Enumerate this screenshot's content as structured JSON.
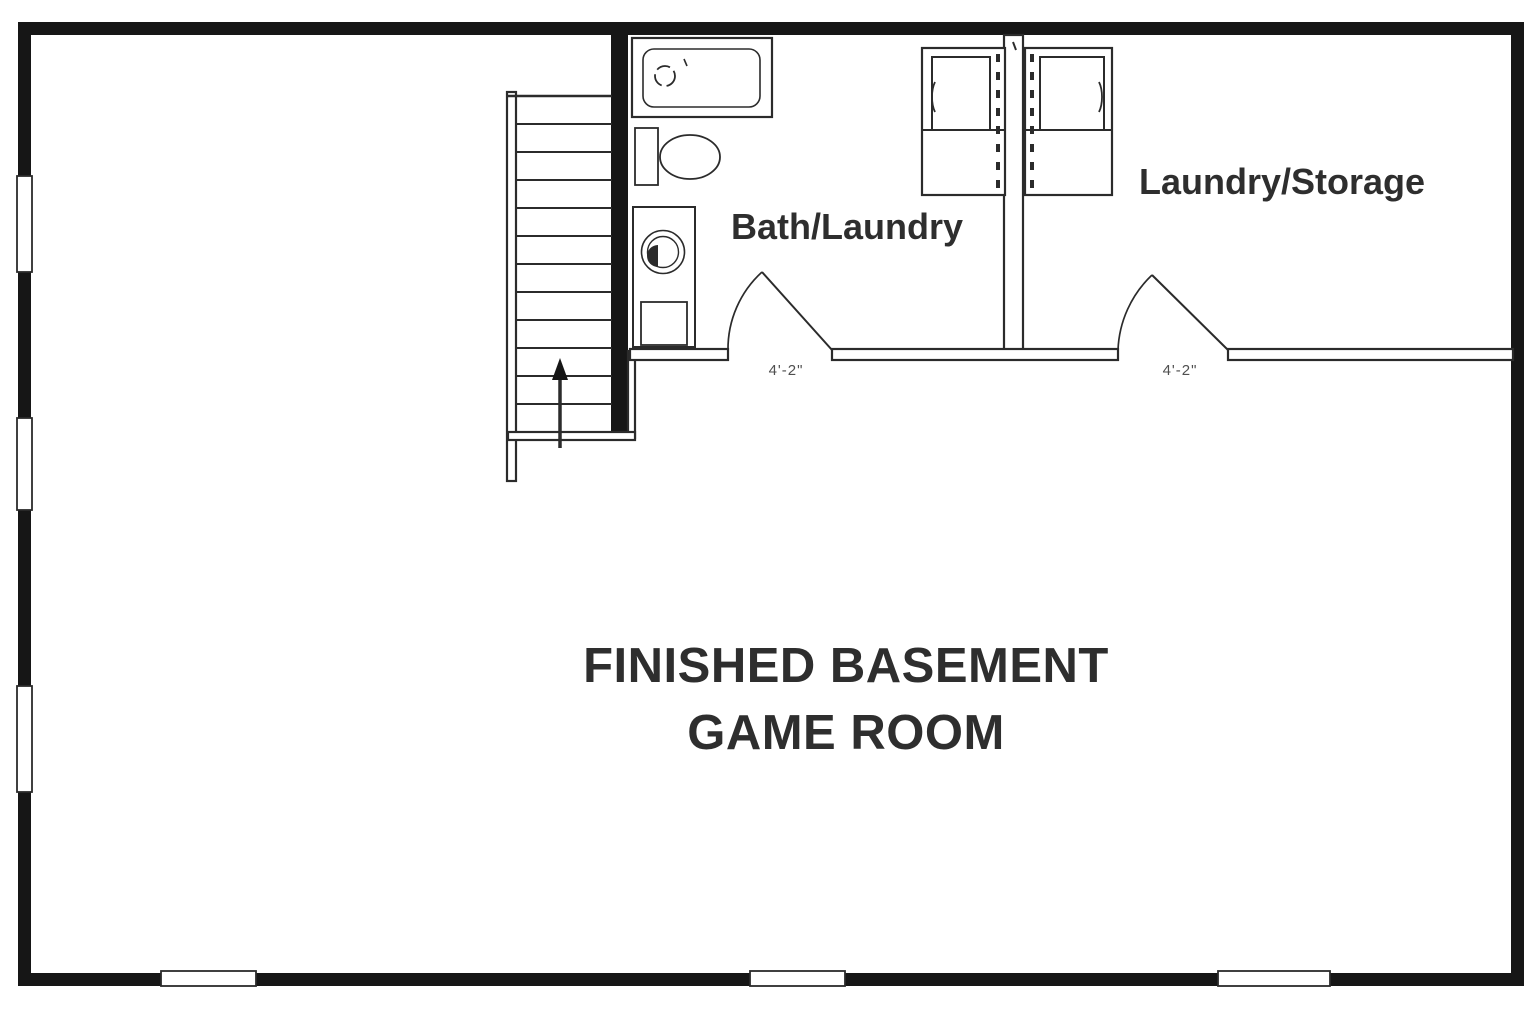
{
  "floor_plan": {
    "title": {
      "line1": "FINISHED BASEMENT",
      "line2": "GAME ROOM"
    },
    "rooms": [
      {
        "id": "bath-laundry",
        "label": "Bath/Laundry",
        "door_width_label": "4'-2\""
      },
      {
        "id": "laundry-storage",
        "label": "Laundry/Storage",
        "door_width_label": "4'-2\""
      },
      {
        "id": "game-room",
        "label": "FINISHED BASEMENT GAME ROOM"
      }
    ],
    "fixtures": [
      {
        "icon": "bathtub-icon"
      },
      {
        "icon": "toilet-icon"
      },
      {
        "icon": "sink-vanity-icon"
      },
      {
        "icon": "washer-icon"
      },
      {
        "icon": "dryer-icon"
      },
      {
        "icon": "staircase-icon"
      },
      {
        "icon": "up-arrow-icon"
      },
      {
        "icon": "door-swing-icon"
      },
      {
        "icon": "window-icon"
      }
    ],
    "colors": {
      "wall": "#161616",
      "line": "#2b2b2b",
      "text": "#2e2e2e",
      "dim-text": "#4f4f4f",
      "bg": "#ffffff"
    }
  }
}
